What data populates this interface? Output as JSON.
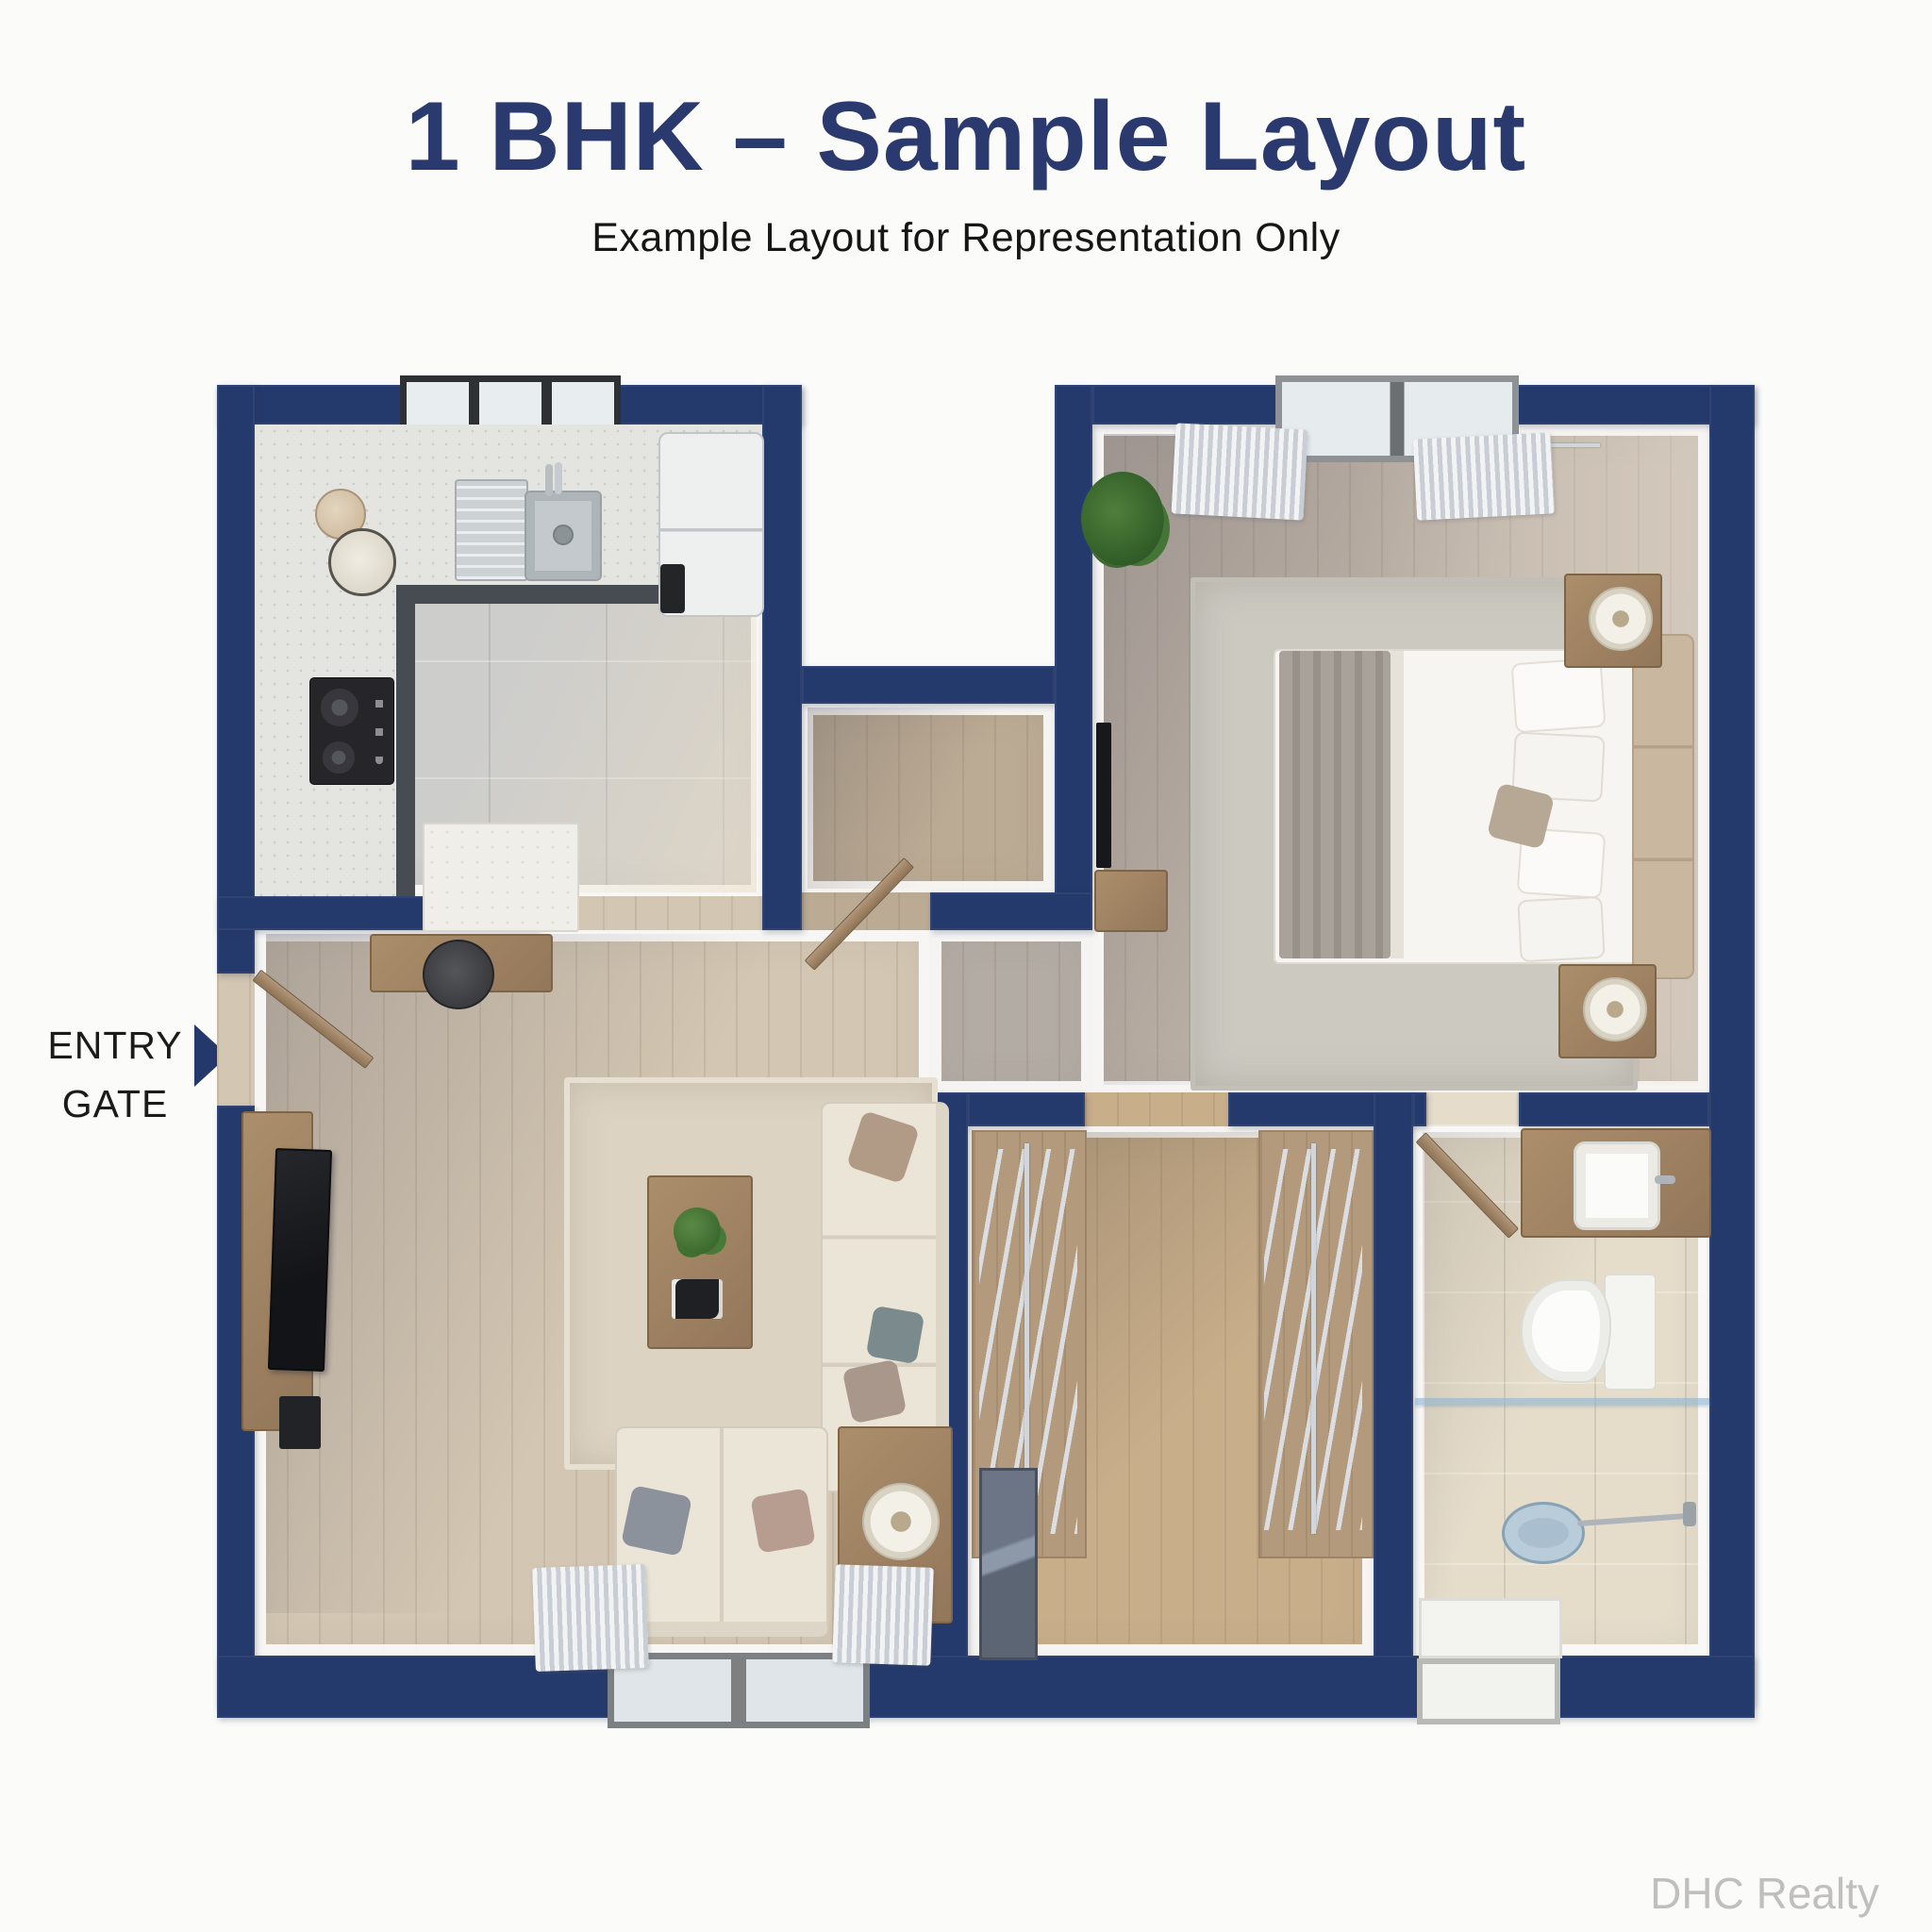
{
  "title": {
    "text": "1 BHK – Sample Layout",
    "color": "#2a3a6e"
  },
  "subtitle": {
    "text": "Example Layout for Representation Only",
    "color": "#161616"
  },
  "entry_gate": {
    "line1": "ENTRY",
    "line2": "GATE",
    "text_color": "#1b1b1b",
    "arrow_color": "#24386b"
  },
  "watermark": {
    "text": "DHC Realty",
    "color": "#c0bfbc"
  },
  "palette": {
    "wall_navy": "#253a6c",
    "background": "#fbfbf9",
    "kitchen_floor": "#cdcdcb",
    "living_floor": "#d3c6b2",
    "corridor_floor": "#b3aca4",
    "bedroom_floor": "#bfb4a8",
    "wardrobe_floor": "#c9ae8a",
    "bathroom_floor": "#e5dcca",
    "furniture_wood": "#a08363",
    "sofa_cream": "#ebe5d8"
  }
}
